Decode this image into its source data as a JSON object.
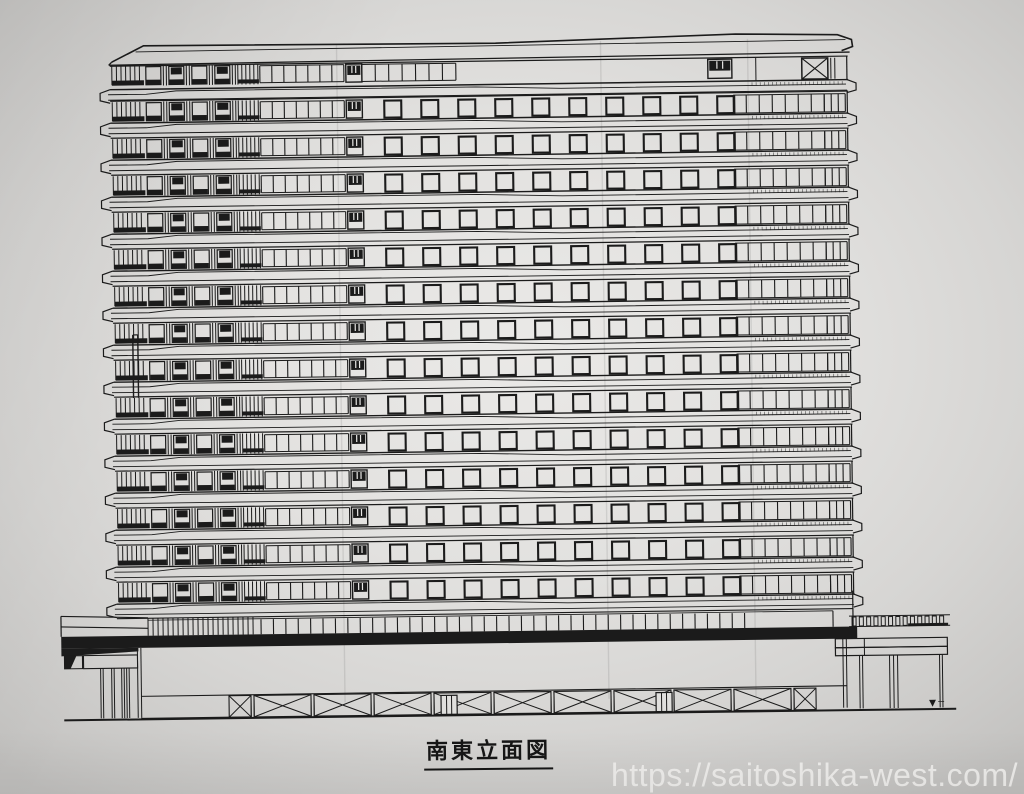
{
  "photo": {
    "ink": "#1b1b1b",
    "paper_center": "#eae9e7",
    "paper_edge": "#c2c1bf"
  },
  "drawing": {
    "caption": "南東立面図",
    "grade_marker": "▼",
    "building": {
      "parapet": true,
      "floors_regular": 14,
      "top_floor_has_x_brace": true,
      "regular_floor_window_groups": {
        "left_louver_lines": 7,
        "silled_windows": 4,
        "center_louver_lines": 6,
        "ribbon_panes": 7,
        "square_windows": 10,
        "right_ribbon_panes": 7,
        "right_narrow_panes": 3
      },
      "base": {
        "colonnade_dense_lines": 22,
        "colonnade_columns": 40,
        "x_braced_wide_panels": 9,
        "x_braced_narrow_panels": 2,
        "door_openings": 2,
        "left_canopy_column_pairs": 4,
        "right_canopy_railing_ticks": 13,
        "right_canopy_column_groups": 3,
        "slab_hatch_ticks": 23
      }
    }
  },
  "watermark": {
    "url_text": "https://saitoshika-west.com/"
  }
}
